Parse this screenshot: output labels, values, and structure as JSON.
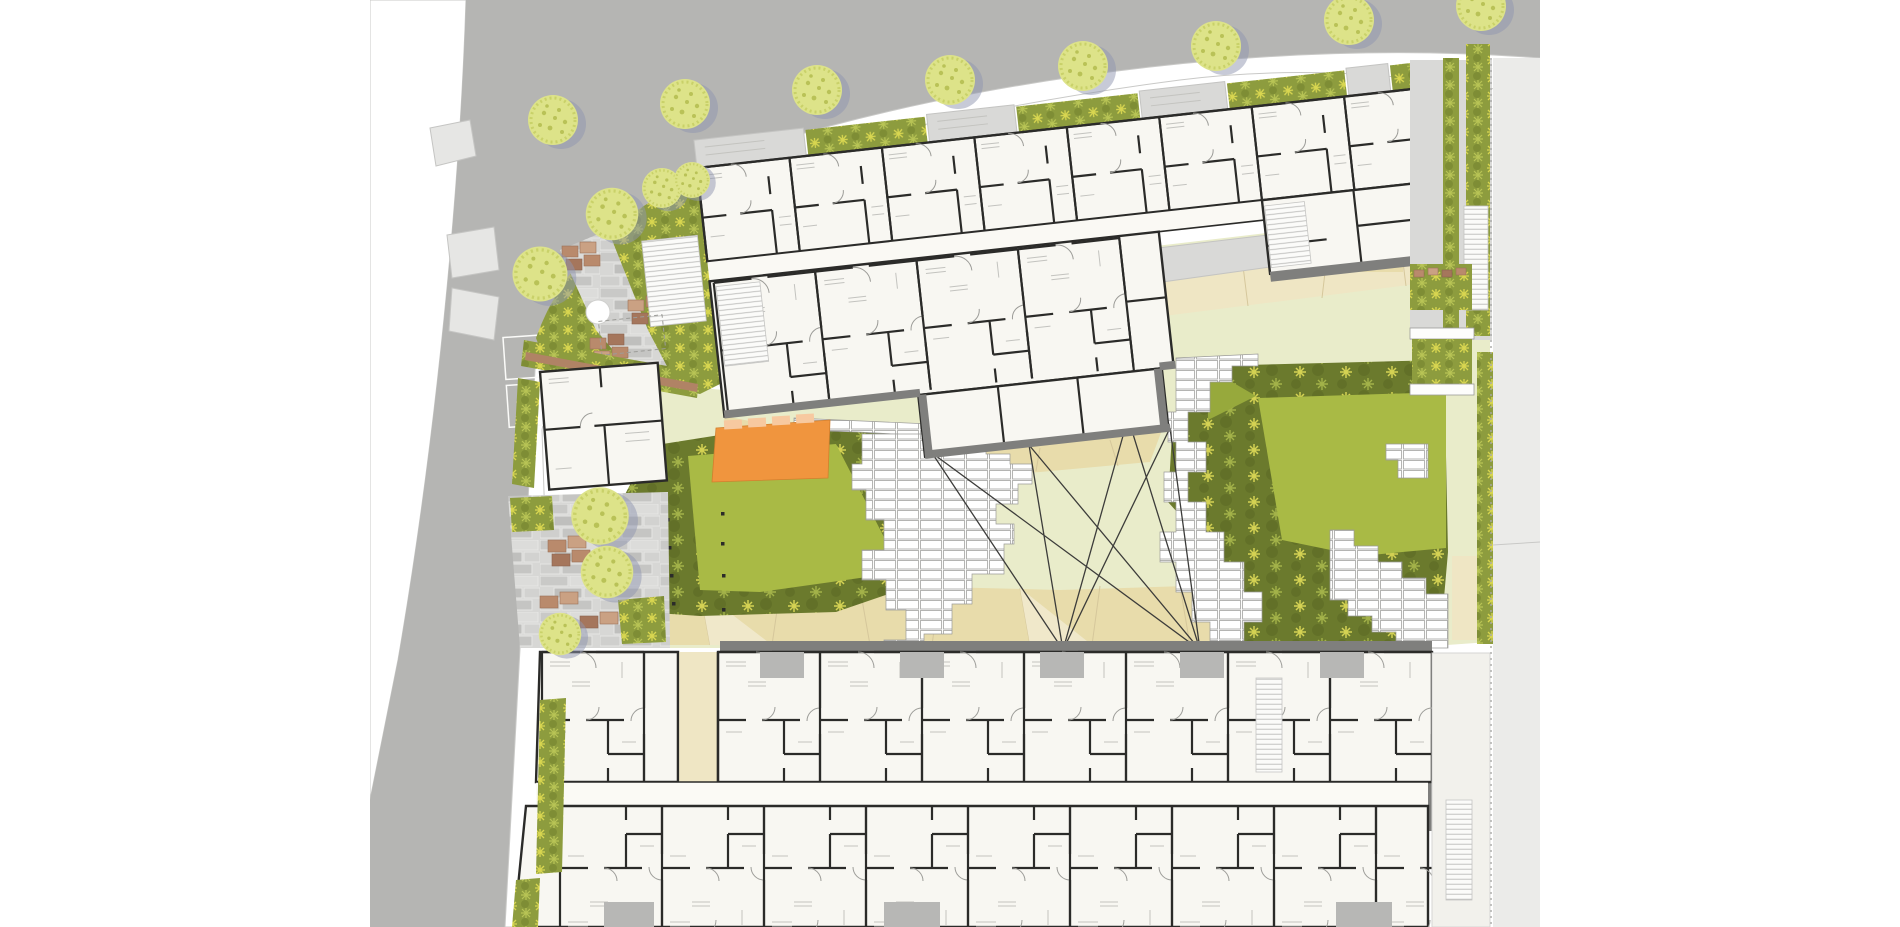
{
  "meta": {
    "description": "Colored architectural ground-floor site plan of a residential block: perimeter street with street trees at top-left corner, two long apartment buildings, central landscaped courtyard with planting beds, lawns, white unit pavers, an orange deck, and sight lines drawn across the courtyard.",
    "visible_text": "none"
  },
  "palette": {
    "page_bg": "#ffffff",
    "street_far_side": "#eeeeec",
    "road": "#b5b5b3",
    "sidewalk": "#dfdfdd",
    "side_street_right": "#ebebe9",
    "building_fill": "#f8f7f2",
    "wall_black": "#2b2b29",
    "wall_gray_band": "#7f7f7d",
    "entry_porch_gray": "#b7b7b5",
    "entry_court_gray": "#d9d9d7",
    "courtyard_paving": "#e9ecca",
    "tan_paving": "#e8dcab",
    "tan_paving_light": "#efe6c4",
    "planting_dark_olive": "#6b7a2d",
    "hedge_olive": "#8d9c3e",
    "plant_star_yellow": "#d8d650",
    "lawn_bright": "#a9ba45",
    "lawn_mid": "#97a93c",
    "paver_white": "#fdfdfc",
    "paver_path_gray": "#cfcfcd",
    "planter_brown": "#b98a6c",
    "tree_canopy": "#dde389",
    "tree_shadow": "#8f96af",
    "orange_deck": "#f0953e",
    "orange_deck_light": "#f7c9a0",
    "sight_line": "#3c3c3a",
    "boundary_line": "#a8a8a6"
  },
  "counts": {
    "street_trees": 8,
    "courtyard_and_garden_trees": 7,
    "sight_lines": 8,
    "courtyard_planting_beds": 2,
    "building_bands": 3
  }
}
